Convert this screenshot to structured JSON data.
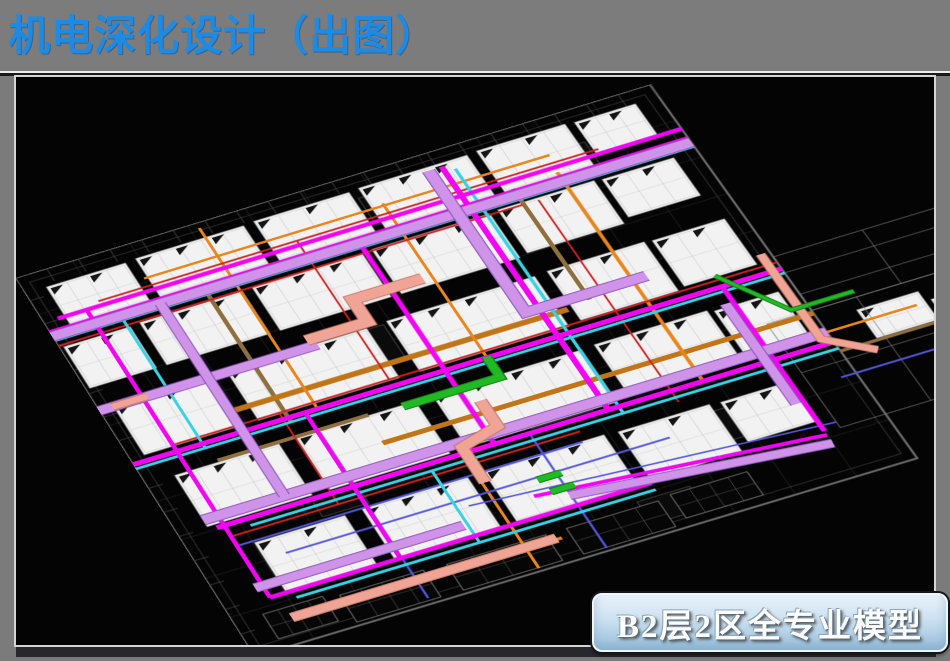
{
  "slide": {
    "title": "机电深化设计（出图）",
    "title_color": "#1d8be4",
    "background_color": "#7b7b7b",
    "caption": "B2层2区全专业模型",
    "caption_text_color": "#fdfdfd",
    "caption_fill_top": "#e9f2fa",
    "caption_fill_bottom": "#a0c5df"
  },
  "viewport": {
    "background": "#040404",
    "border_color": "#d4d4d4"
  },
  "model": {
    "colors": {
      "magenta": "#f402f4",
      "violet": "#cf93e9",
      "violet_dark": "#8e56b8",
      "cyan": "#39d2e4",
      "red": "#cd2222",
      "orange": "#e8851c",
      "orange_tray": "#c07518",
      "tan": "#8f6f3d",
      "blue": "#5457da",
      "green": "#21ba25",
      "green_dark": "#0f7d13",
      "salmon": "#efa495",
      "salmon_dark": "#c57a66",
      "panel": "#f2f2f2",
      "panel_line": "#c6c6c6",
      "panel_edge": "#9a9a9a",
      "wire": "#202020",
      "wire_mid": "#3c3c3c",
      "wire_bright": "#9c9c9c",
      "perimeter": "#6a6a6a",
      "ext_wire": "#787878",
      "glyph": "#141414",
      "block_fill": "#0b0b0b",
      "block_edge": "#444444"
    },
    "grid": {
      "step_u": 80,
      "step_v": 70,
      "u_max": 880,
      "v_max": 700
    },
    "panels": [
      [
        30,
        30,
        110,
        72
      ],
      [
        155,
        28,
        150,
        74
      ],
      [
        320,
        26,
        132,
        76
      ],
      [
        466,
        24,
        150,
        78
      ],
      [
        630,
        22,
        122,
        80
      ],
      [
        764,
        24,
        84,
        62
      ],
      [
        6,
        134,
        92,
        78
      ],
      [
        112,
        132,
        142,
        80
      ],
      [
        268,
        130,
        152,
        82
      ],
      [
        434,
        128,
        162,
        84
      ],
      [
        608,
        126,
        132,
        82
      ],
      [
        750,
        128,
        98,
        72
      ],
      [
        20,
        252,
        132,
        90
      ],
      [
        176,
        250,
        192,
        92
      ],
      [
        396,
        248,
        202,
        94
      ],
      [
        616,
        246,
        132,
        92
      ],
      [
        758,
        248,
        98,
        86
      ],
      [
        40,
        388,
        142,
        94
      ],
      [
        206,
        386,
        162,
        96
      ],
      [
        392,
        384,
        202,
        96
      ],
      [
        612,
        382,
        152,
        94
      ],
      [
        772,
        386,
        86,
        82
      ],
      [
        82,
        528,
        122,
        90
      ],
      [
        228,
        526,
        142,
        92
      ],
      [
        392,
        524,
        162,
        92
      ],
      [
        572,
        526,
        122,
        86
      ],
      [
        708,
        528,
        92,
        72
      ],
      [
        930,
        450,
        82,
        52
      ],
      [
        1020,
        468,
        62,
        46
      ]
    ],
    "wire_panels": [
      [
        140,
        646,
        112,
        48
      ],
      [
        282,
        648,
        132,
        46
      ],
      [
        442,
        648,
        122,
        46
      ],
      [
        582,
        644,
        102,
        42
      ],
      [
        40,
        640,
        80,
        44
      ]
    ],
    "blocks": [
      [
        458,
        40,
        62,
        52
      ],
      [
        318,
        252,
        72,
        62
      ],
      [
        478,
        420,
        82,
        62
      ],
      [
        636,
        538,
        72,
        52
      ],
      [
        178,
        478,
        62,
        42
      ],
      [
        700,
        60,
        60,
        46
      ],
      [
        540,
        640,
        70,
        40
      ]
    ],
    "ext_rects": [
      [
        880,
        330,
        240,
        100
      ],
      [
        820,
        430,
        236,
        190
      ]
    ],
    "ext_lines": [
      [
        [
          880,
          360
        ],
        [
          1120,
          360
        ]
      ],
      [
        [
          880,
          400
        ],
        [
          1120,
          400
        ]
      ],
      [
        [
          820,
          520
        ],
        [
          1056,
          520
        ]
      ],
      [
        [
          940,
          430
        ],
        [
          940,
          620
        ]
      ],
      [
        [
          1000,
          330
        ],
        [
          1000,
          430
        ]
      ]
    ],
    "ducts": [
      {
        "c": "tan",
        "w": 6,
        "pts": [
          [
            212,
            118
          ],
          [
            212,
            360
          ]
        ]
      },
      {
        "c": "tan",
        "w": 6,
        "pts": [
          [
            642,
            100
          ],
          [
            642,
            310
          ]
        ]
      },
      {
        "c": "tan",
        "w": 6,
        "pts": [
          [
            100,
            385
          ],
          [
            305,
            385
          ]
        ]
      },
      {
        "c": "tan",
        "w": 5,
        "pts": [
          [
            880,
            505
          ],
          [
            1040,
            505
          ]
        ]
      },
      {
        "c": "orange_tray",
        "w": 9,
        "pts": [
          [
            150,
            315
          ],
          [
            610,
            315
          ]
        ]
      },
      {
        "c": "orange_tray",
        "w": 8,
        "pts": [
          [
            300,
            435
          ],
          [
            880,
            435
          ]
        ]
      },
      {
        "c": "orange",
        "w": 4,
        "pts": [
          [
            150,
            64
          ],
          [
            710,
            64
          ]
        ]
      },
      {
        "c": "orange",
        "w": 5,
        "pts": [
          [
            100,
            660
          ],
          [
            430,
            660
          ]
        ]
      },
      {
        "c": "orange",
        "w": 4,
        "pts": [
          [
            252,
            10
          ],
          [
            252,
            352
          ]
        ]
      },
      {
        "c": "orange",
        "w": 4,
        "pts": [
          [
            482,
            60
          ],
          [
            482,
            360
          ]
        ]
      },
      {
        "c": "orange",
        "w": 5,
        "pts": [
          [
            705,
            95
          ],
          [
            705,
            488
          ]
        ]
      },
      {
        "c": "orange",
        "w": 4,
        "pts": [
          [
            382,
            488
          ],
          [
            382,
            695
          ]
        ]
      },
      {
        "c": "orange",
        "w": 4,
        "pts": [
          [
            860,
            470
          ],
          [
            1000,
            470
          ]
        ]
      },
      {
        "c": "red",
        "w": 3,
        "pts": [
          [
            80,
            78
          ],
          [
            770,
            78
          ]
        ]
      },
      {
        "c": "red",
        "w": 3,
        "pts": [
          [
            0,
            130
          ],
          [
            640,
            130
          ]
        ]
      },
      {
        "c": "red",
        "w": 3,
        "pts": [
          [
            60,
            340
          ],
          [
            880,
            340
          ]
        ]
      },
      {
        "c": "red",
        "w": 3,
        "pts": [
          [
            60,
            508
          ],
          [
            530,
            508
          ]
        ]
      },
      {
        "c": "red",
        "w": 2.5,
        "pts": [
          [
            355,
            78
          ],
          [
            355,
            340
          ]
        ]
      },
      {
        "c": "red",
        "w": 2.5,
        "pts": [
          [
            662,
            130
          ],
          [
            662,
            508
          ]
        ]
      },
      {
        "c": "red",
        "w": 2.5,
        "pts": [
          [
            205,
            340
          ],
          [
            205,
            508
          ]
        ]
      },
      {
        "c": "blue",
        "w": 3,
        "pts": [
          [
            60,
            525
          ],
          [
            525,
            525
          ]
        ]
      },
      {
        "c": "blue",
        "w": 3,
        "pts": [
          [
            110,
            558
          ],
          [
            625,
            558
          ]
        ]
      },
      {
        "c": "blue",
        "w": 3,
        "pts": [
          [
            237,
            390
          ],
          [
            237,
            690
          ]
        ]
      },
      {
        "c": "blue",
        "w": 3,
        "pts": [
          [
            472,
            488
          ],
          [
            472,
            695
          ]
        ]
      },
      {
        "c": "blue",
        "w": 3,
        "pts": [
          [
            860,
            545
          ],
          [
            1000,
            545
          ]
        ]
      },
      {
        "c": "blue",
        "w": 2.5,
        "pts": [
          [
            350,
            570
          ],
          [
            820,
            610
          ]
        ]
      },
      {
        "c": "cyan",
        "w": 4.5,
        "pts": [
          [
            0,
            120
          ],
          [
            880,
            120
          ]
        ]
      },
      {
        "c": "cyan",
        "w": 4.5,
        "pts": [
          [
            0,
            360
          ],
          [
            880,
            360
          ]
        ]
      },
      {
        "c": "cyan",
        "w": 4.5,
        "pts": [
          [
            90,
            500
          ],
          [
            880,
            500
          ]
        ]
      },
      {
        "c": "cyan",
        "w": 4.5,
        "pts": [
          [
            90,
            630
          ],
          [
            570,
            630
          ]
        ]
      },
      {
        "c": "cyan",
        "w": 4.5,
        "pts": [
          [
            592,
            40
          ],
          [
            592,
            500
          ]
        ]
      },
      {
        "c": "cyan",
        "w": 4,
        "pts": [
          [
            95,
            120
          ],
          [
            95,
            360
          ]
        ]
      },
      {
        "c": "cyan",
        "w": 4,
        "pts": [
          [
            335,
            500
          ],
          [
            335,
            630
          ]
        ]
      },
      {
        "c": "magenta",
        "w": 7,
        "pts": [
          [
            20,
            86
          ],
          [
            880,
            86
          ]
        ]
      },
      {
        "c": "magenta",
        "w": 7,
        "pts": [
          [
            0,
            104
          ],
          [
            880,
            104
          ]
        ]
      },
      {
        "c": "magenta",
        "w": 8,
        "pts": [
          [
            0,
            352
          ],
          [
            880,
            352
          ]
        ]
      },
      {
        "c": "magenta",
        "w": 8,
        "pts": [
          [
            50,
            488
          ],
          [
            880,
            488
          ]
        ]
      },
      {
        "c": "magenta",
        "w": 7,
        "pts": [
          [
            60,
            618
          ],
          [
            570,
            618
          ]
        ]
      },
      {
        "c": "magenta",
        "w": 6,
        "pts": [
          [
            60,
            86
          ],
          [
            60,
            618
          ]
        ]
      },
      {
        "c": "magenta",
        "w": 7,
        "pts": [
          [
            425,
            104
          ],
          [
            425,
            488
          ]
        ]
      },
      {
        "c": "magenta",
        "w": 8,
        "pts": [
          [
            578,
            30
          ],
          [
            578,
            488
          ]
        ]
      },
      {
        "c": "magenta",
        "w": 7,
        "pts": [
          [
            800,
            352
          ],
          [
            800,
            618
          ]
        ]
      },
      {
        "c": "magenta",
        "w": 6,
        "pts": [
          [
            235,
            352
          ],
          [
            235,
            618
          ]
        ]
      },
      {
        "c": "magenta",
        "w": 6,
        "pts": [
          [
            430,
            585
          ],
          [
            800,
            625
          ]
        ]
      },
      {
        "c": "violet",
        "w": 15,
        "pts": [
          [
            0,
            112
          ],
          [
            880,
            112
          ]
        ]
      },
      {
        "c": "violet",
        "w": 14,
        "pts": [
          [
            0,
            252
          ],
          [
            300,
            252
          ]
        ]
      },
      {
        "c": "violet",
        "w": 15,
        "pts": [
          [
            40,
            470
          ],
          [
            880,
            470
          ]
        ]
      },
      {
        "c": "violet",
        "w": 13,
        "pts": [
          [
            50,
            597
          ],
          [
            330,
            597
          ]
        ]
      },
      {
        "c": "violet",
        "w": 12,
        "pts": [
          [
            150,
            112
          ],
          [
            150,
            470
          ]
        ]
      },
      {
        "c": "violet",
        "w": 15,
        "pts": [
          [
            560,
            30
          ],
          [
            560,
            300
          ],
          [
            724,
            300
          ]
        ]
      },
      {
        "c": "violet",
        "w": 12,
        "pts": [
          [
            790,
            380
          ],
          [
            790,
            565
          ]
        ]
      },
      {
        "c": "violet",
        "w": 12,
        "pts": [
          [
            470,
            600
          ],
          [
            800,
            640
          ]
        ]
      },
      {
        "c": "salmon",
        "w": 16,
        "pts": [
          [
            290,
            240
          ],
          [
            374,
            240
          ],
          [
            374,
            198
          ],
          [
            470,
            198
          ]
        ]
      },
      {
        "c": "salmon",
        "w": 13,
        "pts": [
          [
            70,
            658
          ],
          [
            424,
            658
          ]
        ]
      },
      {
        "c": "salmon",
        "w": 14,
        "pts": [
          [
            442,
            415
          ],
          [
            442,
            462
          ],
          [
            386,
            478
          ],
          [
            386,
            542
          ]
        ]
      },
      {
        "c": "salmon",
        "w": 10,
        "pts": [
          [
            868,
            320
          ],
          [
            868,
            478
          ],
          [
            922,
            520
          ]
        ]
      },
      {
        "c": "salmon",
        "w": 10,
        "pts": [
          [
            18,
            252
          ],
          [
            66,
            252
          ]
        ]
      },
      {
        "c": "green",
        "w": 11,
        "pts": [
          [
            350,
            388
          ],
          [
            482,
            388
          ],
          [
            482,
            350
          ]
        ]
      },
      {
        "c": "green",
        "w": 5,
        "pts": [
          [
            800,
            332
          ],
          [
            858,
            420
          ],
          [
            942,
            420
          ]
        ]
      },
      {
        "c": "green",
        "w": 9,
        "pts": [
          [
            446,
            562
          ],
          [
            478,
            562
          ]
        ]
      },
      {
        "c": "green",
        "w": 9,
        "pts": [
          [
            452,
            586
          ],
          [
            484,
            586
          ]
        ]
      }
    ]
  }
}
